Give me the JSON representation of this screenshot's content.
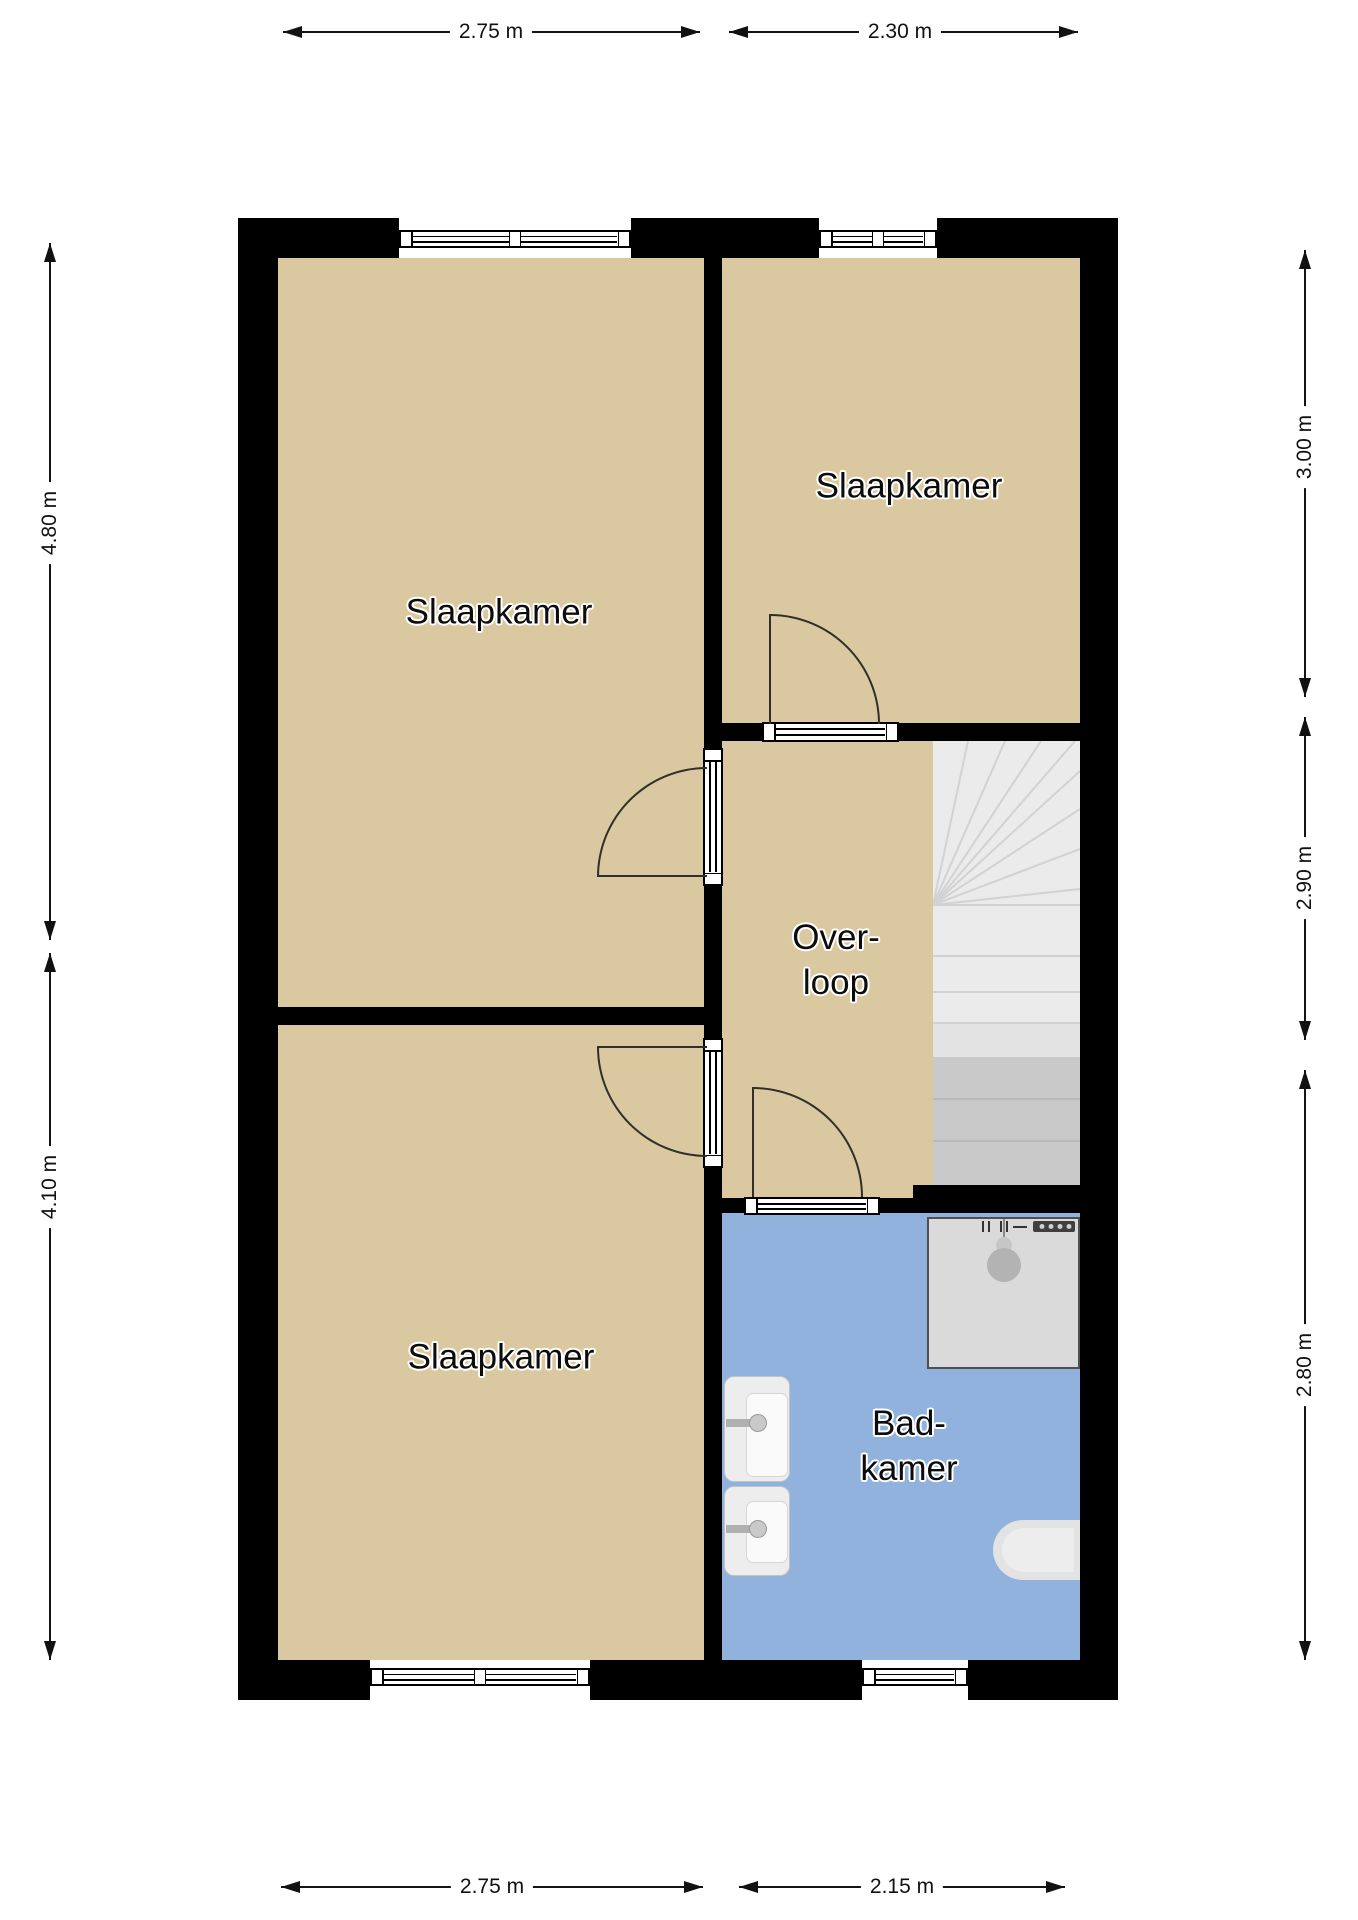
{
  "floor_plan": {
    "rooms": [
      {
        "name": "slaapkamer-top-left",
        "label": "Slaapkamer"
      },
      {
        "name": "slaapkamer-top-right",
        "label": "Slaapkamer"
      },
      {
        "name": "slaapkamer-bottom-left",
        "label": "Slaapkamer"
      },
      {
        "name": "overloop",
        "label_line1": "Over-",
        "label_line2": "loop"
      },
      {
        "name": "badkamer",
        "label_line1": "Bad-",
        "label_line2": "kamer"
      }
    ],
    "dimensions": {
      "top": [
        {
          "label": "2.75 m"
        },
        {
          "label": "2.30 m"
        }
      ],
      "bottom": [
        {
          "label": "2.75 m"
        },
        {
          "label": "2.15 m"
        }
      ],
      "left": [
        {
          "label": "4.80 m"
        },
        {
          "label": "4.10 m"
        }
      ],
      "right": [
        {
          "label": "3.00 m"
        },
        {
          "label": "2.90 m"
        },
        {
          "label": "2.80 m"
        }
      ]
    },
    "fixtures": [
      {
        "name": "staircase"
      },
      {
        "name": "shower"
      },
      {
        "name": "sink"
      },
      {
        "name": "sink"
      },
      {
        "name": "toilet"
      }
    ],
    "colors": {
      "wall": "#000000",
      "room_floor": "#d9c8a0",
      "bathroom_floor": "#90b2dd",
      "stairs": "#ebebeb",
      "fixture_gray": "#dadada",
      "background": "#ffffff"
    }
  }
}
